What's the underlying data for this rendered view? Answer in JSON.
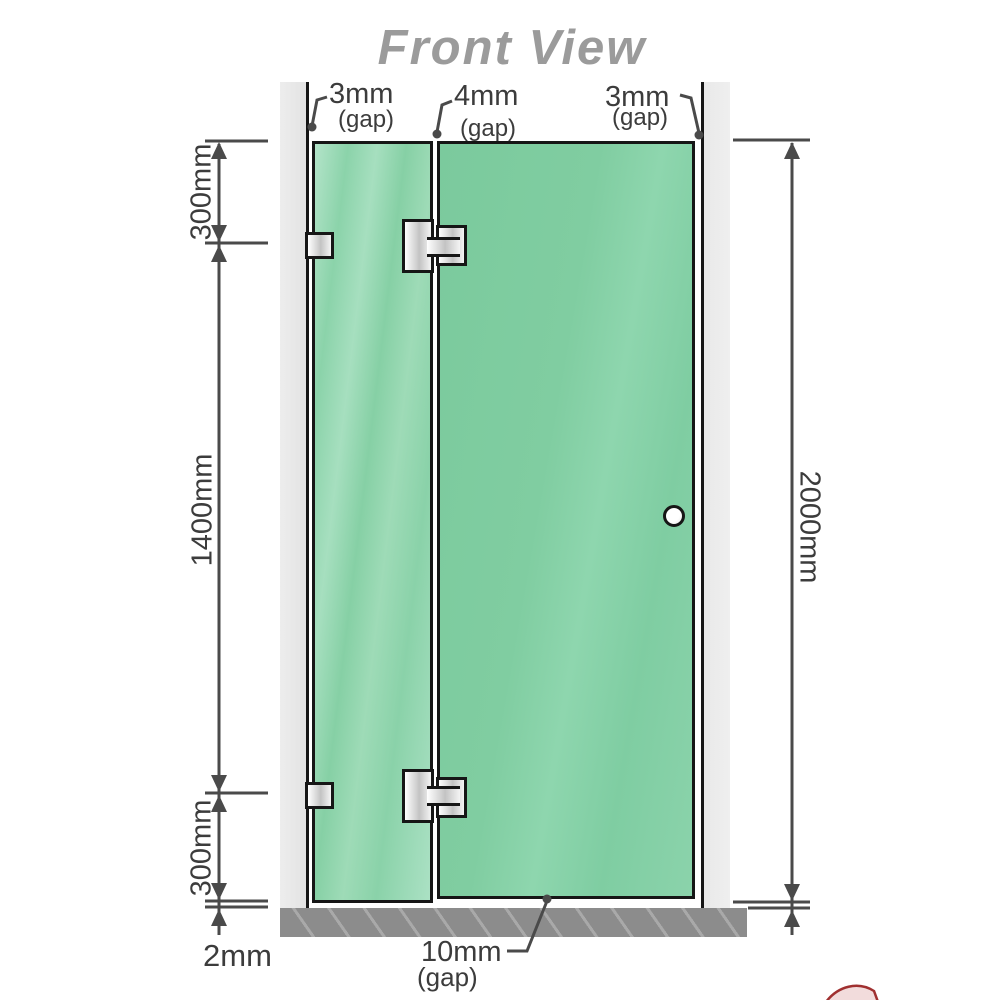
{
  "title": "Front View",
  "colors": {
    "glass_green": "#82cfa4",
    "glass_green_light": "#a9e0c2",
    "wall_gray": "#e8e8e8",
    "base_gray": "#8c8c8c",
    "outline_black": "#161616",
    "dimension_line": "#4a4a4a",
    "label_text": "#3c3c3c",
    "title_text": "#9b9b9b",
    "logo_red": "#a03030"
  },
  "gaps_top": [
    {
      "value": "3mm",
      "note": "(gap)"
    },
    {
      "value": "4mm",
      "note": "(gap)"
    },
    {
      "value": "3mm",
      "note": "(gap)"
    }
  ],
  "dimensions": {
    "left_upper": "300mm",
    "left_middle": "1400mm",
    "left_lower": "300mm",
    "left_floor_gap": "2mm",
    "right_total": "2000mm",
    "bottom_gap": {
      "value": "10mm",
      "note": "(gap)"
    }
  }
}
